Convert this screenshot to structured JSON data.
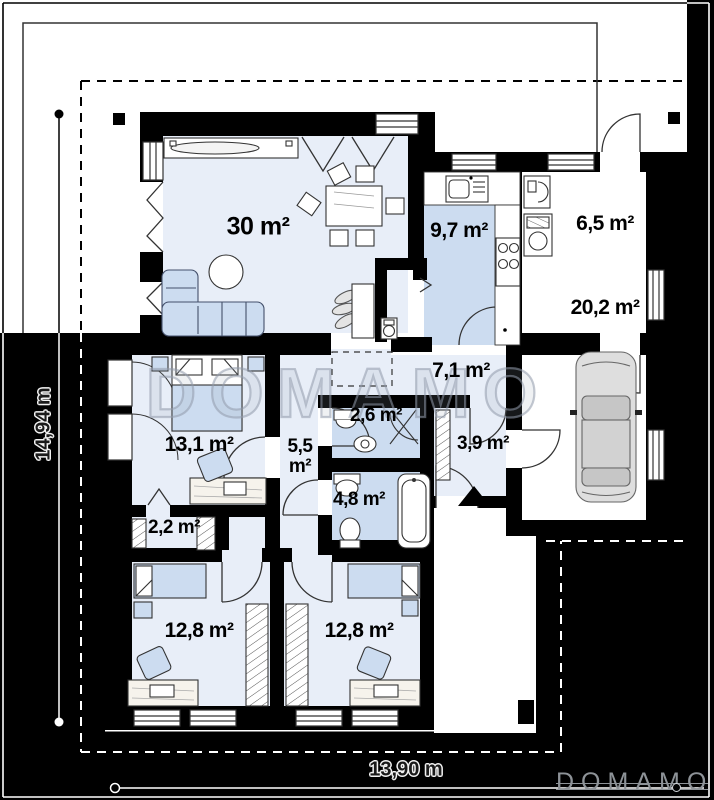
{
  "watermark": "DOMAMO",
  "brand": {
    "logo_text": "DOMAMO"
  },
  "dimensions": {
    "height_label": "14,94 m",
    "width_label": "13,90 m"
  },
  "rooms": [
    {
      "name": "living-room",
      "label": "30 m²"
    },
    {
      "name": "kitchen",
      "label": "9,7 m²"
    },
    {
      "name": "utility-room",
      "label": "6,5 m²"
    },
    {
      "name": "garage",
      "label": "20,2 m²"
    },
    {
      "name": "hall",
      "label": "7,1 m²"
    },
    {
      "name": "wc",
      "label": "2,6 m²"
    },
    {
      "name": "corridor",
      "label": "5,5 m²"
    },
    {
      "name": "vestibule",
      "label": "3,9 m²"
    },
    {
      "name": "bathroom",
      "label": "4,8 m²"
    },
    {
      "name": "bedroom-1",
      "label": "13,1 m²"
    },
    {
      "name": "wardrobe",
      "label": "2,2 m²"
    },
    {
      "name": "bedroom-2",
      "label": "12,8 m²"
    },
    {
      "name": "bedroom-3",
      "label": "12,8 m²"
    }
  ],
  "colors": {
    "background": "#000000",
    "wall": "#000000",
    "paper": "#ffffff",
    "room_tint_light": "#e8eef8",
    "room_tint_medium": "#ccdcf0",
    "watermark_gray": "#98a1b0",
    "logo_gray": "#8d9297"
  }
}
